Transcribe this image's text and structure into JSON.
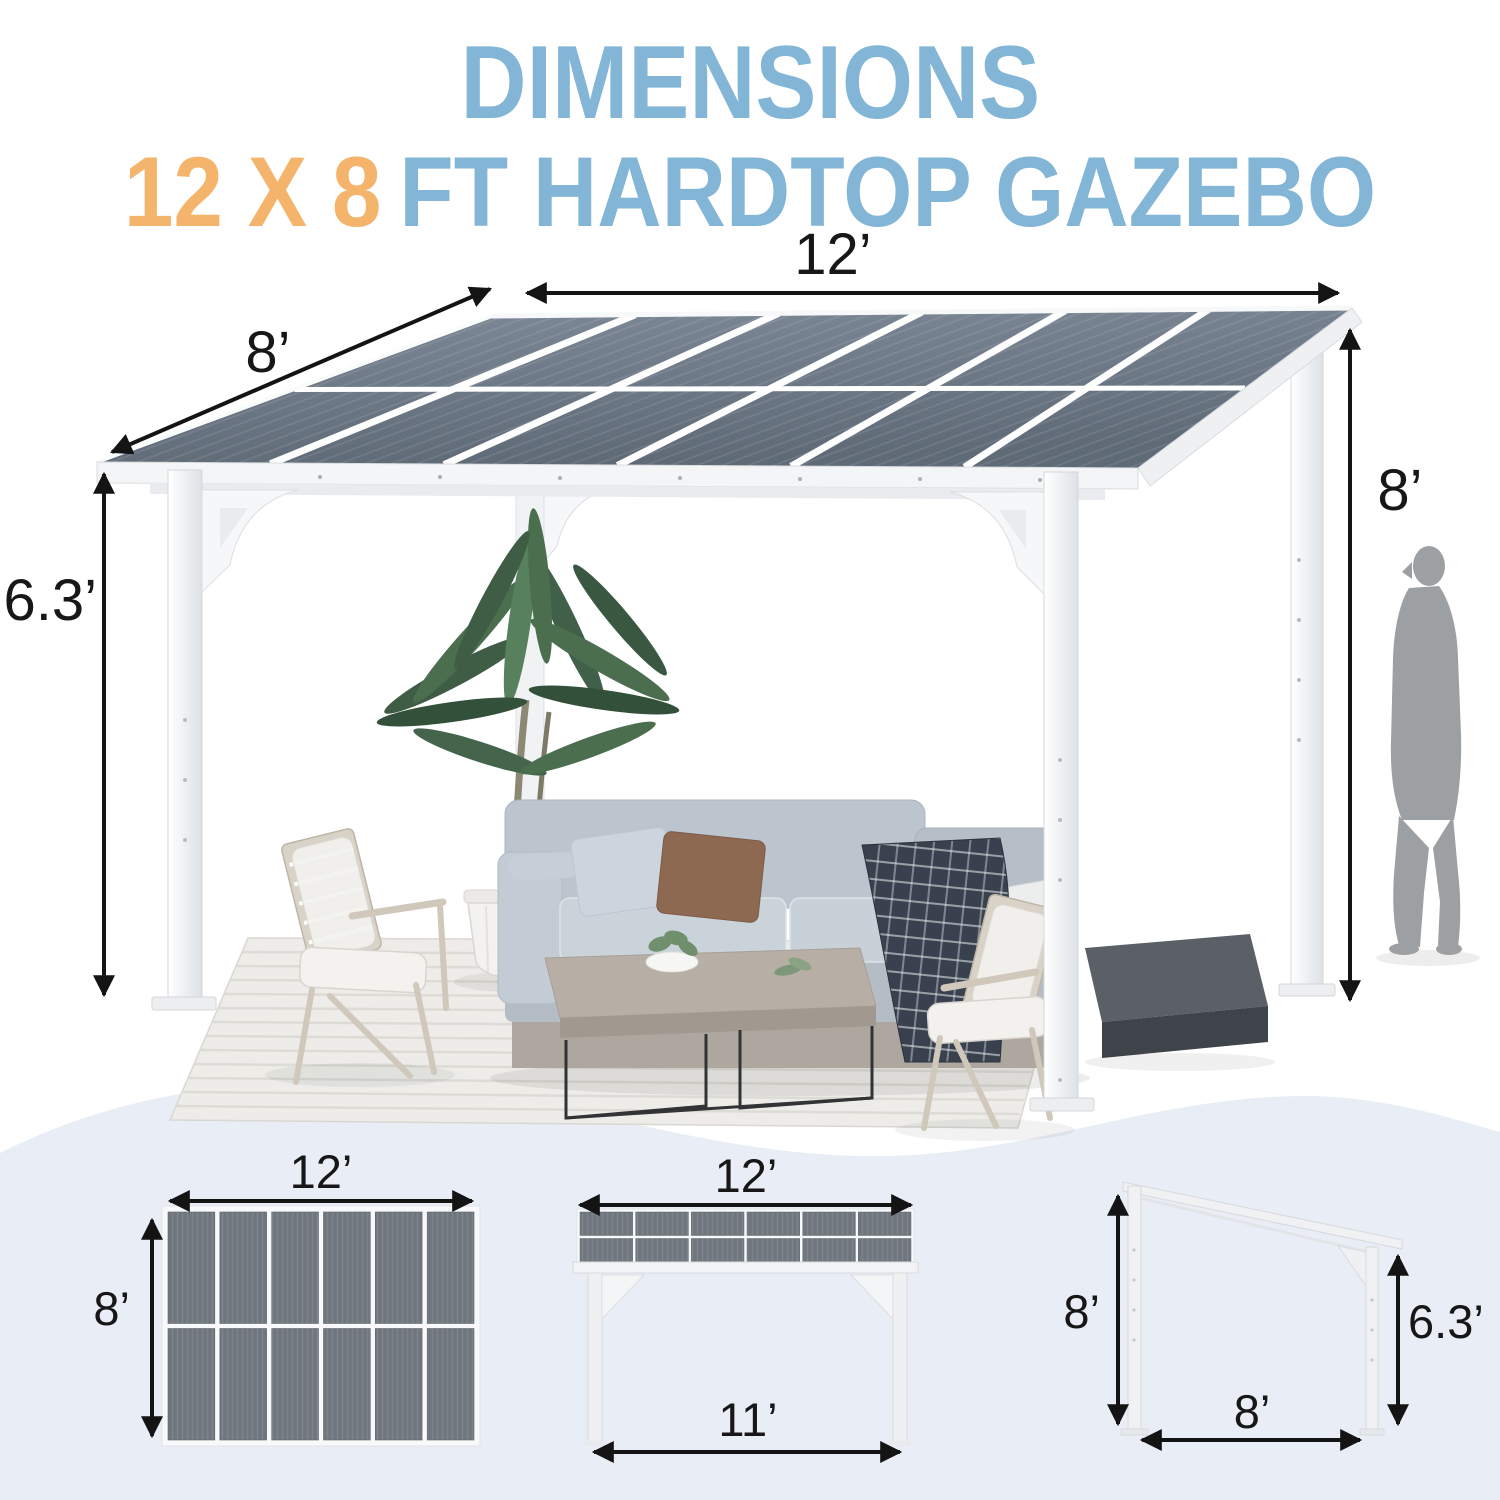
{
  "header": {
    "title": "DIMENSIONS",
    "subtitle_accent": "12 X 8",
    "subtitle_rest": "FT HARDTOP GAZEBO"
  },
  "main_diagram": {
    "roof_width_label": "12’",
    "roof_depth_label": "8’",
    "rear_height_label": "8’",
    "front_height_label": "6.3’"
  },
  "bottom_diagrams": {
    "top_view": {
      "width_label": "12’",
      "depth_label": "8’"
    },
    "front_view": {
      "width_label": "12’",
      "post_span_label": "11’"
    },
    "side_view": {
      "rear_height_label": "8’",
      "front_height_label": "6.3’",
      "depth_label": "8’"
    }
  },
  "colors": {
    "title_blue": "#82b5d6",
    "accent_orange": "#f4b46b",
    "panel_slate": "#6e7883",
    "wave_blue": "#e9eef6",
    "figure_gray": "#9da0a3",
    "arrow_black": "#141414"
  }
}
